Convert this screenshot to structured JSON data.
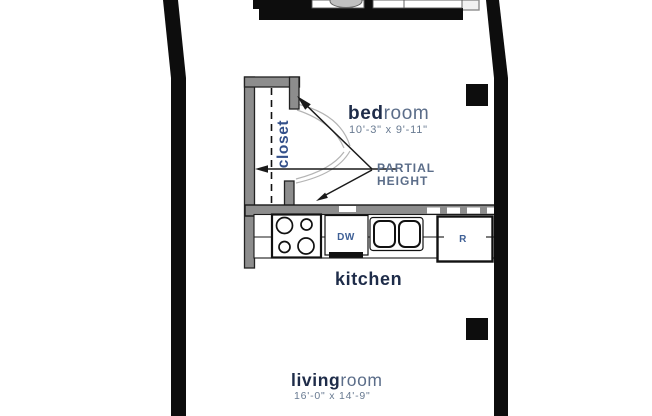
{
  "meta": {
    "type": "apartment floor plan"
  },
  "rooms": {
    "bedroom": {
      "label_bold": "bed",
      "label_light": "room",
      "dimensions": "10'-3\" x 9'-11\""
    },
    "closet": {
      "label": "closet"
    },
    "kitchen": {
      "label": "kitchen"
    },
    "living_room": {
      "label_bold": "living",
      "label_light": "room",
      "dimensions": "16'-0\" x 14'-9\""
    }
  },
  "annotations": {
    "partial_height": {
      "line1": "PARTIAL",
      "line2": "HEIGHT"
    }
  },
  "appliances": {
    "dishwasher_label": "DW",
    "refrigerator_label": "R"
  },
  "colors": {
    "wall": "#0d0d0d",
    "partial_wall": "#8d8d8d",
    "label_dark": "#1e2c49",
    "label_light": "#5b6d89",
    "dimension_text": "#687a91",
    "appliance_text": "#3f6096"
  }
}
